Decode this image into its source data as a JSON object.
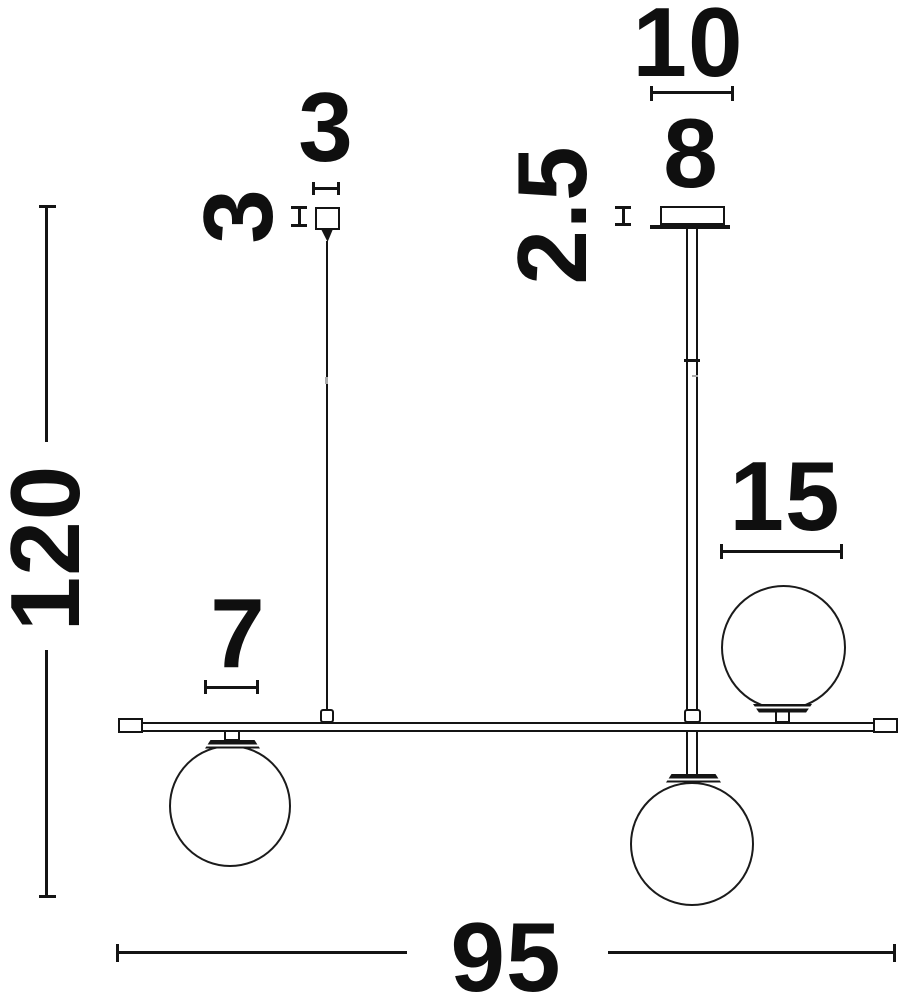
{
  "drawing": {
    "description": "pendant-lamp-dimension-drawing",
    "colors": {
      "ink": "#141414",
      "background": "#ffffff"
    },
    "labels": {
      "plate_width": "10",
      "canopy_width": "8",
      "canopy_thickness": "2.5",
      "cube_width": "3",
      "cube_height": "3",
      "overall_drop": "120",
      "globe_diameter": "15",
      "small_spacing": "7",
      "bar_length": "95"
    }
  }
}
